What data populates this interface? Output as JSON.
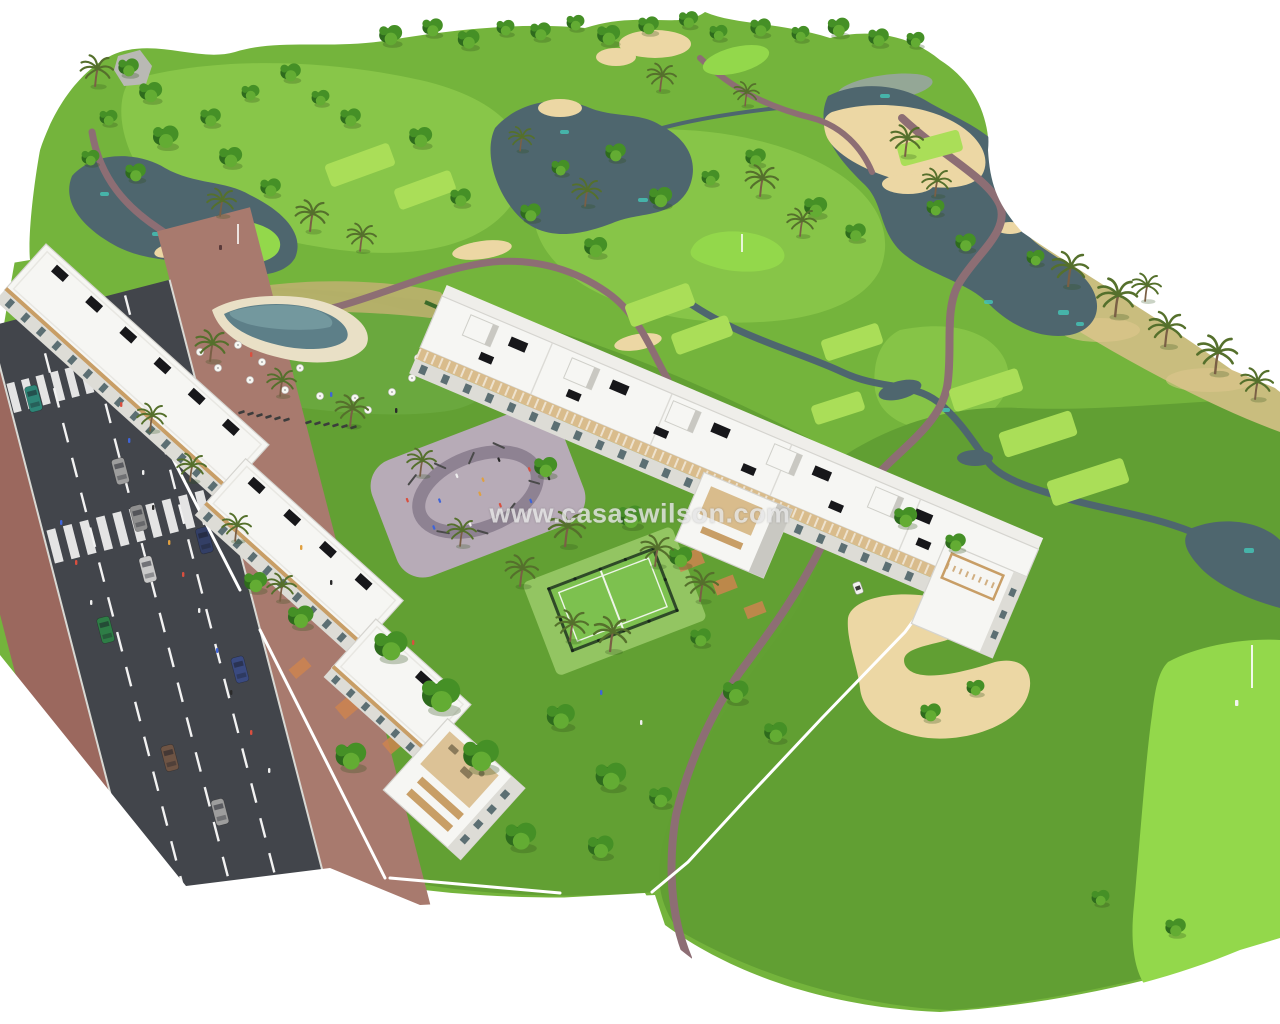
{
  "meta": {
    "kind": "aerial-architectural-render",
    "description": "3D aerial render of a white apartment resort development beside a golf course with lakes, bunkers, pool, padel court, playground and an access road"
  },
  "watermark": {
    "text": "www.casaswilson.com"
  },
  "scene_elements": {
    "golf_course": "golf-course",
    "lakes": "lakes",
    "sand_bunkers": "sand-bunkers",
    "cart_paths": "cart-paths",
    "apartment_building_left": "apartment-building-left",
    "apartment_building_center": "apartment-building-center",
    "swimming_pool": "swimming-pool",
    "playground_plaza": "playground-plaza",
    "padel_court": "padel-court",
    "access_road": "access-road",
    "crosswalk": "crosswalk",
    "cars": "cars",
    "golf_flags": "golf-flags",
    "golf_cart": "golf-cart",
    "trees": "trees",
    "palm_trees": "palm-trees"
  },
  "palette": {
    "grass1": "#74b43c",
    "grass2": "#619f33",
    "grass3": "#8cc94b",
    "fairway": "#a3d955",
    "green1": "#93d84b",
    "teebox": "#aade58",
    "scrub": "#c9bd7e",
    "sand": "#ecd7a4",
    "sand2": "#dfc68e",
    "lake": "#4e666e",
    "lake2": "#3e545c",
    "laketeal": "#45c1b4",
    "lakegray": "#9aa5a6",
    "path": "#8d6e74",
    "road": "#42454b",
    "roadline": "#f2f2f2",
    "sidewalk": "#9b685e",
    "sidewalk2": "#a87a6e",
    "bldg": "#f6f6f3",
    "bldgshade": "#dddcd6",
    "bldgdark": "#c9c8c2",
    "wood": "#c89e66",
    "wood2": "#d9bc8c",
    "glass": "#5c6f73",
    "panel": "#17171a",
    "terracotta": "#cd8350",
    "plaza": "#b7abb7",
    "plazapath": "#8e8292",
    "pool": "#5d7f88",
    "pooldeck": "#e9e0c6",
    "court": "#7dc14f",
    "fence": "#2f4a28",
    "treedark": "#2e6b1d",
    "tree": "#459026",
    "treelight": "#63ac33",
    "palmgreen": "#55702c",
    "trunk": "#7a5f45",
    "watermark": "#e6e6e6"
  }
}
